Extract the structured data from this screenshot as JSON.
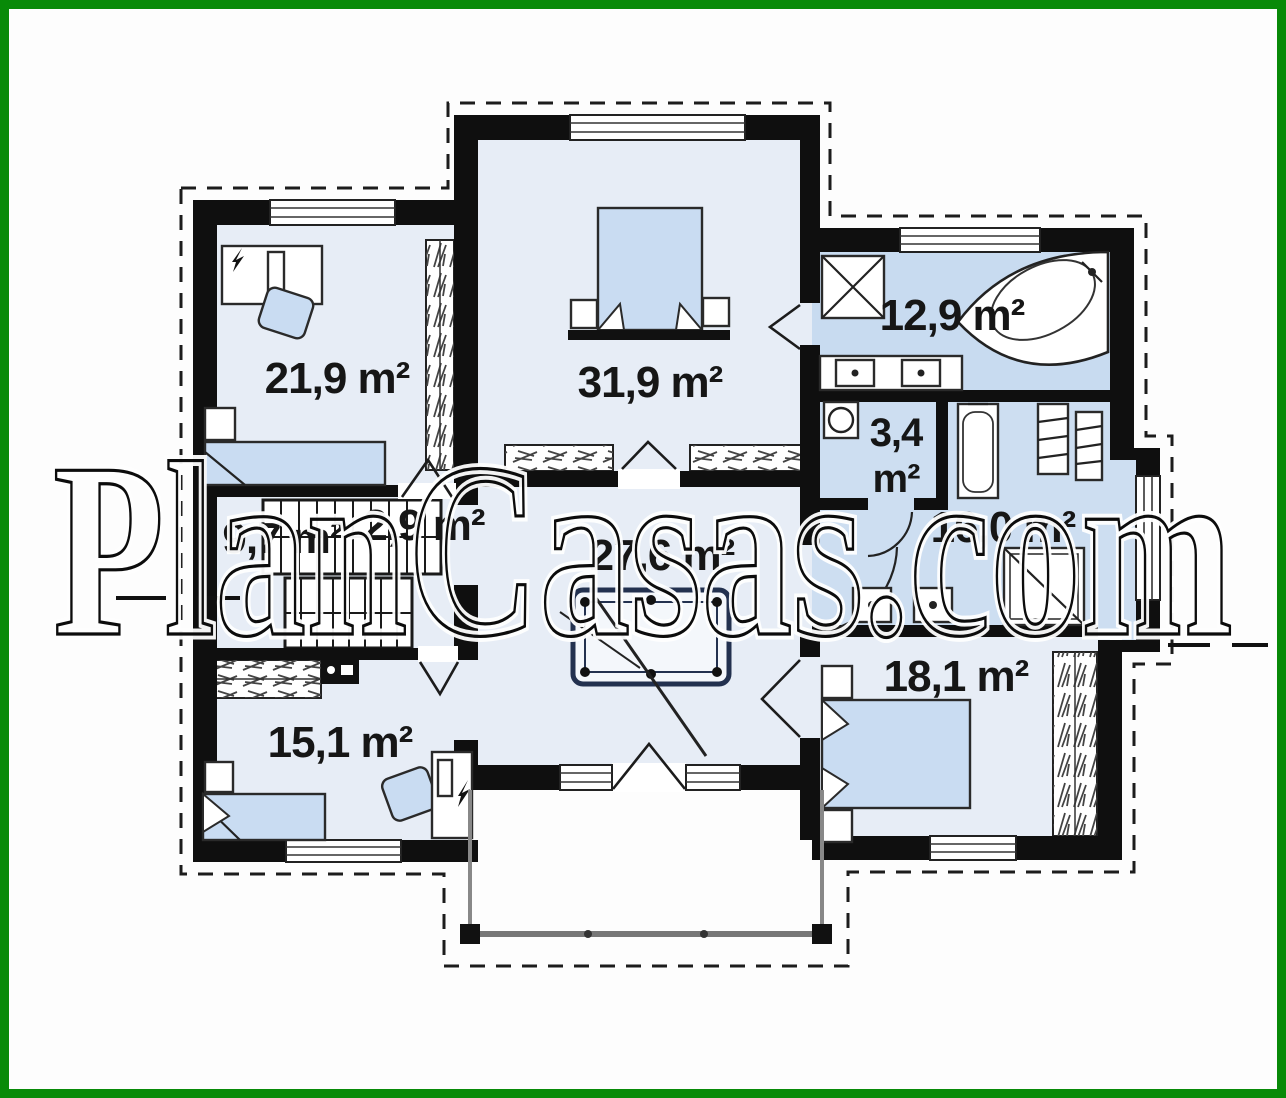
{
  "frame": {
    "border_color": "#088a08",
    "background": "#fdfdfd"
  },
  "watermark": {
    "text": "PlanCasas.com"
  },
  "palette": {
    "wall": "#0f0f0f",
    "room_light": "#e7edf6",
    "room_bath": "#c8dbf0",
    "room_bath2": "#cddef1",
    "furniture_blue": "#c9dcf2",
    "outline_dash": "#1c1c1c"
  },
  "rooms": [
    {
      "name": "bedroom-top-left",
      "label": "21,9 m²"
    },
    {
      "name": "bedroom-top-center",
      "label": "31,9 m²"
    },
    {
      "name": "bathroom-top-right",
      "label": "12,9 m²"
    },
    {
      "name": "wc-small",
      "label": "3,4 m²",
      "label_lines": [
        "3,4",
        "m²"
      ]
    },
    {
      "name": "bathroom-right",
      "label": "16,0 m²"
    },
    {
      "name": "stair-hall",
      "label": "9,7 m²"
    },
    {
      "name": "closet-stairs",
      "label": "2,9 m²"
    },
    {
      "name": "hall-center",
      "label": "27,6 m²"
    },
    {
      "name": "bedroom-bottom-left",
      "label": "15,1 m²"
    },
    {
      "name": "bedroom-bottom-right",
      "label": "18,1 m²"
    }
  ]
}
